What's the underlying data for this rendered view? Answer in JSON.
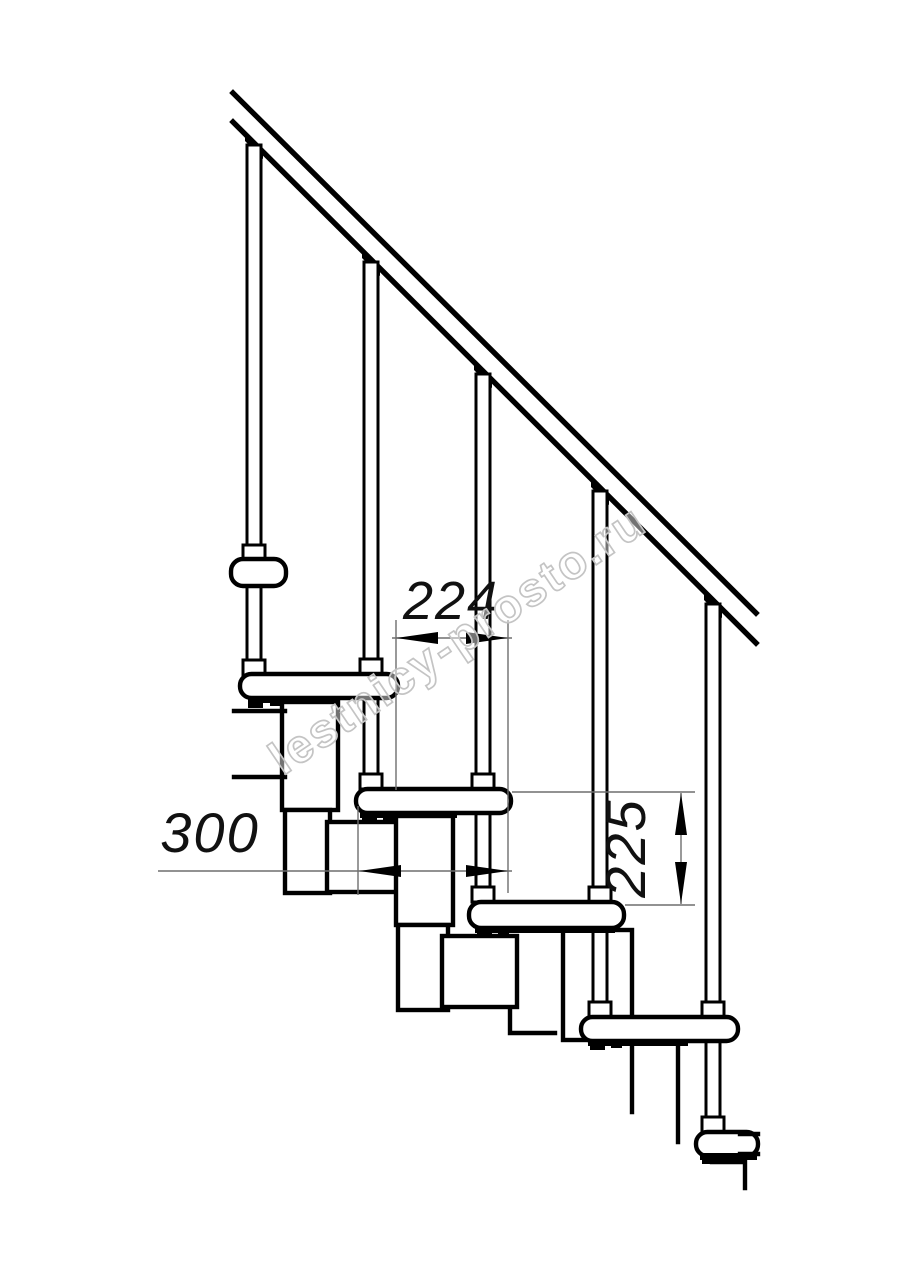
{
  "page": {
    "background": "#ffffff"
  },
  "drawing": {
    "kind": "technical-line-drawing",
    "subject": "modular staircase side elevation",
    "line_color": "#000000",
    "hairline_color": "#6e6e6e",
    "counts": {
      "balusters": 5,
      "treads": 5
    },
    "dimensions": {
      "run": {
        "value": "224",
        "orientation": "horizontal",
        "meaning": "step run between tread edges"
      },
      "depth": {
        "value": "300",
        "orientation": "horizontal",
        "meaning": "tread depth"
      },
      "rise": {
        "value": "225",
        "orientation": "vertical",
        "meaning": "step rise"
      }
    },
    "watermark": {
      "text": "lestnicy-prosto.ru",
      "color": "#c4c4c4"
    }
  }
}
